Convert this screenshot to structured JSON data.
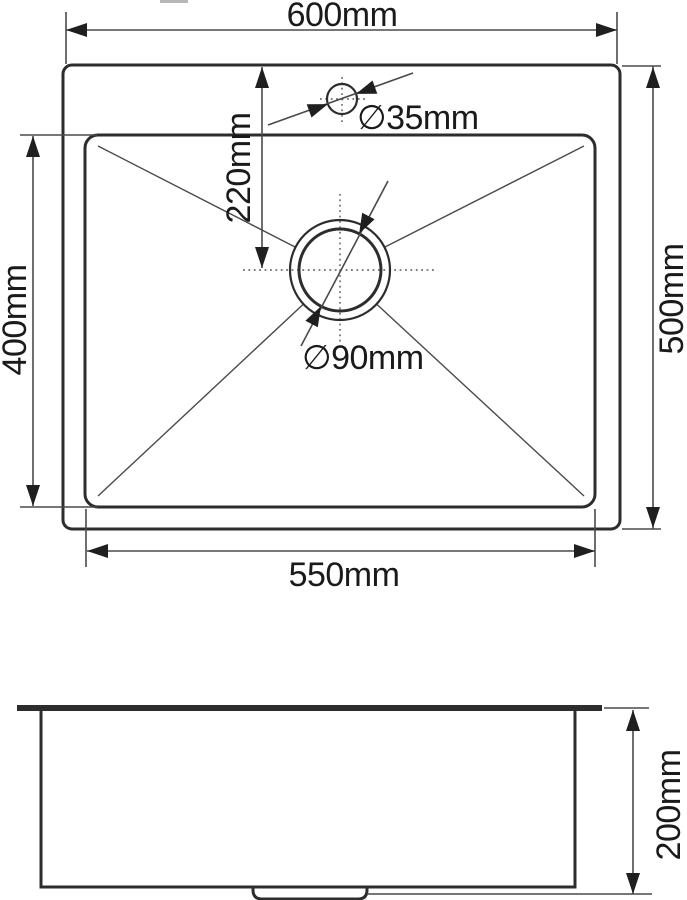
{
  "drawing": {
    "type": "technical-drawing",
    "subject": "kitchen sink dimension drawing, top view and side view",
    "views": {
      "top": {
        "overall_width_label": "600mm",
        "overall_depth_label": "500mm",
        "bowl_width_label": "550mm",
        "bowl_depth_label": "400mm",
        "faucet_center_offset_label": "220mm",
        "faucet_hole_diameter_label": "∅35mm",
        "drain_diameter_label": "∅90mm"
      },
      "side": {
        "bowl_height_label": "200mm"
      }
    },
    "colors": {
      "background": "#ffffff",
      "shape_line": "#2d2d2d",
      "dimension_line": "#4a4a4a",
      "text": "#1a1a1a"
    }
  }
}
